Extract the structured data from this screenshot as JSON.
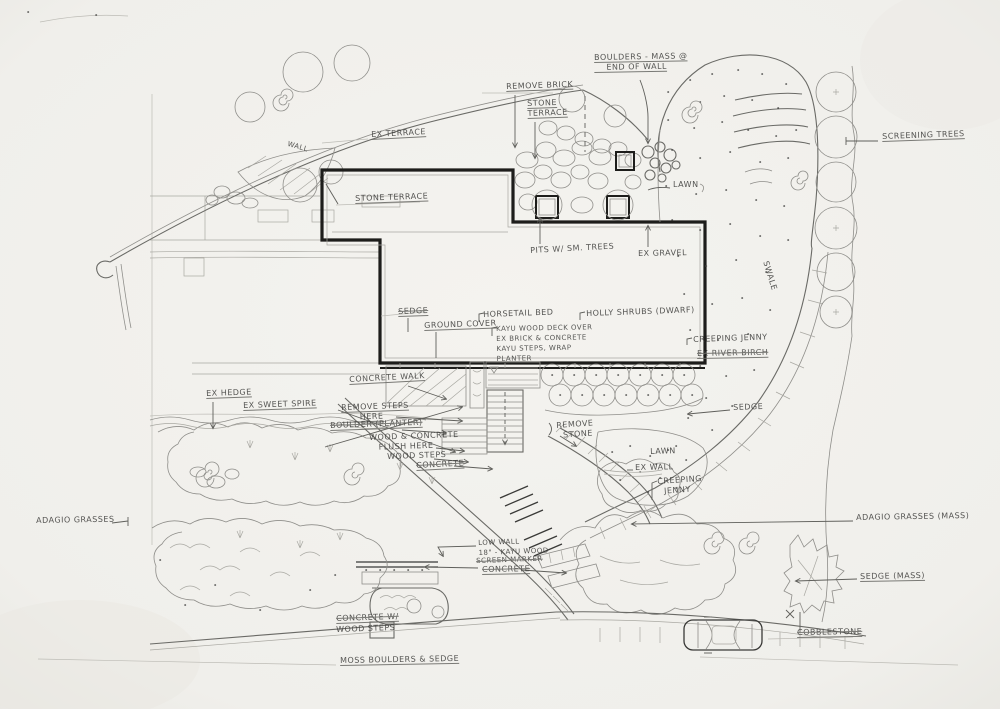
{
  "palette": {
    "paper": "#f1f0ec",
    "pencil": "#8f8e8a",
    "ink": "#1d1d1b",
    "label_text": "#3e3e3c"
  },
  "plan_labels": [
    {
      "name": "boulders-mass-label",
      "x": 594,
      "y": 53,
      "rot": -1,
      "u": 1,
      "text": "BOULDERS - MASS @\n    END OF WALL"
    },
    {
      "name": "remove-brick-label",
      "x": 506,
      "y": 82,
      "rot": -2,
      "u": 1,
      "text": "REMOVE BRICK"
    },
    {
      "name": "stone-terrace-upper-label",
      "x": 527,
      "y": 99,
      "rot": -2,
      "u": 1,
      "text": "STONE\nTERRACE"
    },
    {
      "name": "screening-trees-label",
      "x": 882,
      "y": 132,
      "rot": -2,
      "u": 1,
      "text": "SCREENING TREES"
    },
    {
      "name": "ex-terrace-label",
      "x": 371,
      "y": 130,
      "rot": -3,
      "u": 1,
      "text": "EX TERRACE"
    },
    {
      "name": "wall-inline-label",
      "x": 289,
      "y": 139,
      "rot": 16,
      "size": 7,
      "text": "WALL"
    },
    {
      "name": "stone-terrace-label",
      "x": 355,
      "y": 194,
      "rot": -2,
      "u": 1,
      "text": "STONE TERRACE"
    },
    {
      "name": "pits-small-trees-label",
      "x": 530,
      "y": 246,
      "rot": -3,
      "text": "PITS W/ SM. TREES"
    },
    {
      "name": "ex-gravel-label",
      "x": 638,
      "y": 249,
      "rot": -1,
      "text": "EX GRAVEL"
    },
    {
      "name": "lawn-upper-label",
      "x": 673,
      "y": 180,
      "rot": 0,
      "text": "LAWN"
    },
    {
      "name": "swale-label",
      "x": 770,
      "y": 260,
      "rot": 73,
      "text": "SWALE"
    },
    {
      "name": "sedge-upper-label",
      "x": 398,
      "y": 307,
      "rot": -2,
      "u": 1,
      "s": 1,
      "text": "SEDGE"
    },
    {
      "name": "ground-cover-label",
      "x": 424,
      "y": 321,
      "rot": -2,
      "u": 1,
      "text": "GROUND COVER"
    },
    {
      "name": "horsetail-label",
      "x": 483,
      "y": 310,
      "rot": -2,
      "text": "HORSETAIL BED"
    },
    {
      "name": "kayu-deck-note",
      "x": 496,
      "y": 324,
      "rot": -1,
      "size": 7,
      "text": "KAYU WOOD DECK OVER\nEX BRICK & CONCRETE\nKAYU STEPS, WRAP\nPLANTER"
    },
    {
      "name": "holly-shrubs-label",
      "x": 586,
      "y": 309,
      "rot": -2,
      "text": "HOLLY SHRUBS (DWARF)"
    },
    {
      "name": "creeping-jenny-upper-label",
      "x": 693,
      "y": 335,
      "rot": -2,
      "text": "CREEPING JENNY"
    },
    {
      "name": "ex-river-birch-label",
      "x": 697,
      "y": 349,
      "rot": -1,
      "u": 1,
      "s": 1,
      "text": "EX RIVER BIRCH"
    },
    {
      "name": "ex-hedge-label",
      "x": 206,
      "y": 389,
      "rot": -2,
      "u": 1,
      "text": "EX HEDGE"
    },
    {
      "name": "ex-sweet-spire-label",
      "x": 243,
      "y": 401,
      "rot": -2,
      "u": 1,
      "text": "EX SWEET SPIRE"
    },
    {
      "name": "concrete-walk-label",
      "x": 349,
      "y": 375,
      "rot": -3,
      "u": 1,
      "text": "CONCRETE WALK"
    },
    {
      "name": "remove-steps-label",
      "x": 341,
      "y": 403,
      "rot": -2,
      "u": 1,
      "text": "REMOVE STEPS\n      HERE"
    },
    {
      "name": "boulder-planter-label",
      "x": 330,
      "y": 421,
      "rot": -2,
      "u": 1,
      "s": 1,
      "text": "BOULDER (PLANTER)"
    },
    {
      "name": "wood-concrete-flush-label",
      "x": 369,
      "y": 433,
      "rot": -2,
      "text": "WOOD & CONCRETE\n   FLUSH HERE"
    },
    {
      "name": "wood-steps-label",
      "x": 387,
      "y": 452,
      "rot": -2,
      "text": "WOOD STEPS"
    },
    {
      "name": "concrete-mid-label",
      "x": 416,
      "y": 461,
      "rot": -3,
      "u": 1,
      "s": 1,
      "text": "CONCRETE"
    },
    {
      "name": "remove-stone-label",
      "x": 556,
      "y": 421,
      "rot": -4,
      "text": "REMOVE\n  STONE"
    },
    {
      "name": "lawn-lower-label",
      "x": 650,
      "y": 447,
      "rot": -2,
      "text": "LAWN"
    },
    {
      "name": "ex-wall-label",
      "x": 635,
      "y": 463,
      "rot": -1,
      "text": "EX WALL"
    },
    {
      "name": "creeping-jenny-lower-label",
      "x": 657,
      "y": 477,
      "rot": -4,
      "text": "CREEPING\n  JENNY"
    },
    {
      "name": "sedge-mid-label",
      "x": 733,
      "y": 403,
      "rot": -2,
      "text": "SEDGE"
    },
    {
      "name": "adagio-grasses-label",
      "x": 36,
      "y": 516,
      "rot": -1,
      "text": "ADAGIO GRASSES"
    },
    {
      "name": "low-wall-note",
      "x": 478,
      "y": 538,
      "rot": -2,
      "size": 7,
      "text": "LOW WALL\n18\" - KAYU WOOD"
    },
    {
      "name": "screen-marker-note",
      "x": 476,
      "y": 556,
      "rot": -2,
      "size": 7,
      "s": 1,
      "text": "SCREEN MARKER"
    },
    {
      "name": "concrete-lower-label",
      "x": 482,
      "y": 565,
      "rot": -1,
      "u": 1,
      "s": 1,
      "text": "CONCRETE"
    },
    {
      "name": "concrete-steps-label",
      "x": 336,
      "y": 614,
      "rot": -2,
      "u": 1,
      "s": 1,
      "text": "CONCRETE W/"
    },
    {
      "name": "wood-steps-lower-label",
      "x": 336,
      "y": 625,
      "rot": -2,
      "text": "WOOD STEPS"
    },
    {
      "name": "moss-boulders-label",
      "x": 340,
      "y": 656,
      "rot": -1,
      "u": 1,
      "text": "MOSS BOULDERS & SEDGE"
    },
    {
      "name": "adagio-grasses-mass-label",
      "x": 856,
      "y": 513,
      "rot": -1,
      "text": "ADAGIO GRASSES (MASS)"
    },
    {
      "name": "sedge-mass-label",
      "x": 860,
      "y": 572,
      "rot": -1,
      "u": 1,
      "text": "SEDGE (MASS)"
    },
    {
      "name": "cobblestone-label",
      "x": 797,
      "y": 628,
      "rot": -1,
      "u": 1,
      "s": 1,
      "text": "COBBLESTONE"
    }
  ]
}
